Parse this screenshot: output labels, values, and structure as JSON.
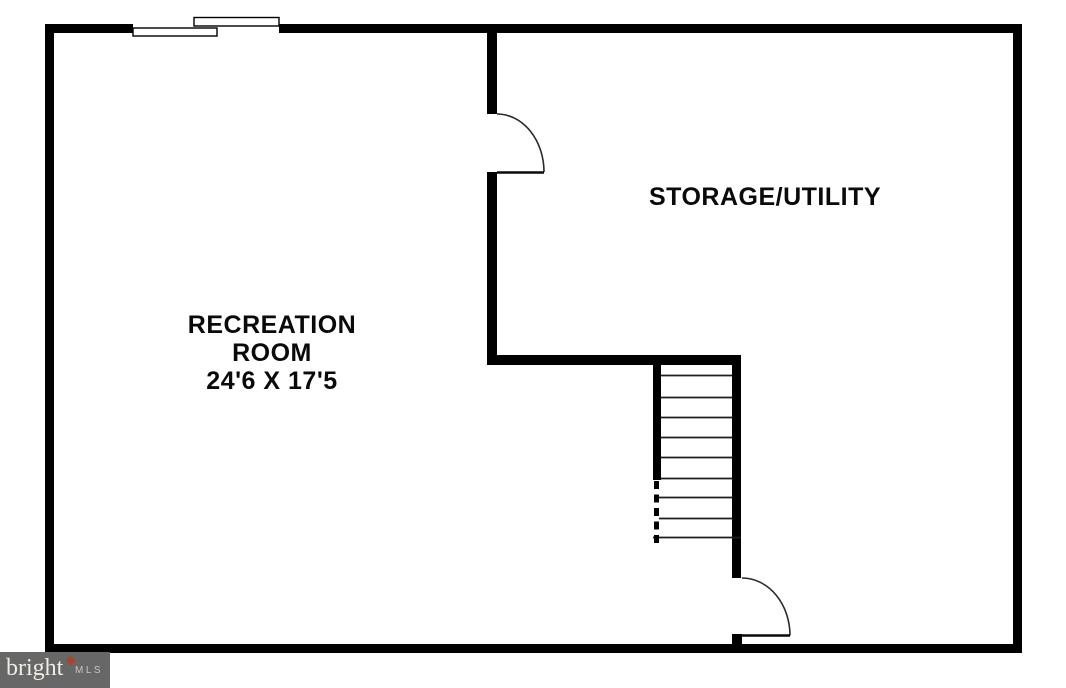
{
  "colors": {
    "background": "#ffffff",
    "wall": "#000000",
    "watermark-bg": "#676767",
    "watermark-text": "#f0ede7",
    "watermark-mls": "#c9c5bf",
    "watermark-accent": "#a8432c"
  },
  "floorplan": {
    "rooms": [
      {
        "id": "recreation-room",
        "label_lines": [
          "RECREATION",
          "ROOM",
          "24'6 X 17'5"
        ],
        "dimensions": "24'6 X 17'5"
      },
      {
        "id": "storage-utility",
        "label": "STORAGE/UTILITY"
      }
    ],
    "features": [
      {
        "id": "window-top-wall"
      },
      {
        "id": "door-storage"
      },
      {
        "id": "staircase",
        "visible_treads": 9
      },
      {
        "id": "door-bottom"
      }
    ]
  },
  "watermark": {
    "brand": "bright",
    "suffix": "MLS"
  }
}
